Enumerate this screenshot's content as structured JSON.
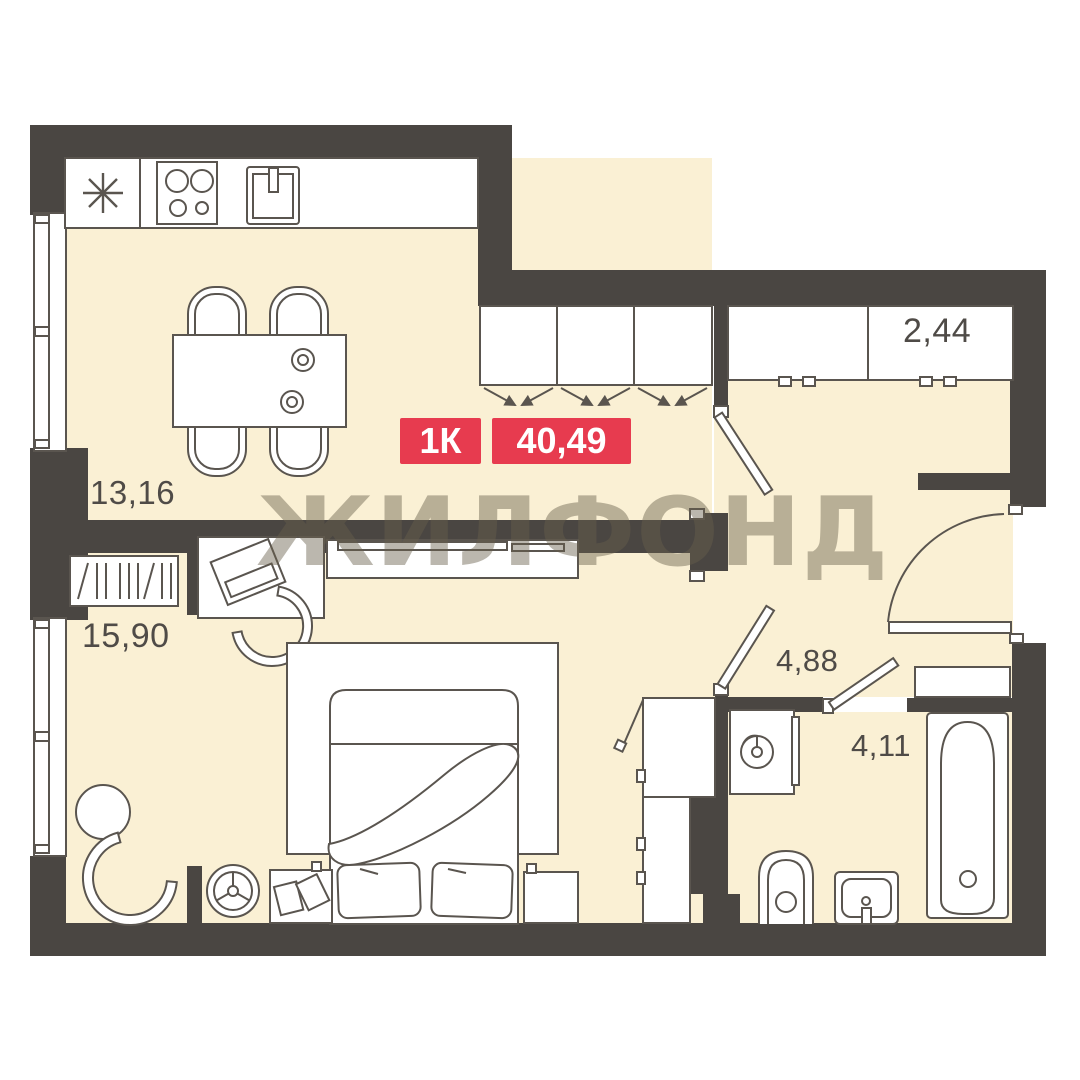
{
  "badge": {
    "room_type": "1К",
    "total_area": "40,49",
    "color": "#e73b4f"
  },
  "watermark": {
    "text": "ЖИЛФОНД"
  },
  "rooms": [
    {
      "name": "kitchen-living-room",
      "area": "13,16"
    },
    {
      "name": "bedroom",
      "area": "15,90"
    },
    {
      "name": "wardrobe-niche",
      "area": "2,44"
    },
    {
      "name": "hallway",
      "area": "4,88"
    },
    {
      "name": "bathroom",
      "area": "4,11"
    }
  ],
  "colors": {
    "wall": "#4a4642",
    "floor": "#faf0d4",
    "furniture_outline": "#5a554f",
    "label_text": "#4f4b47",
    "badge_red": "#e73b4f",
    "watermark_gray": "rgba(104,96,75,0.45)"
  }
}
